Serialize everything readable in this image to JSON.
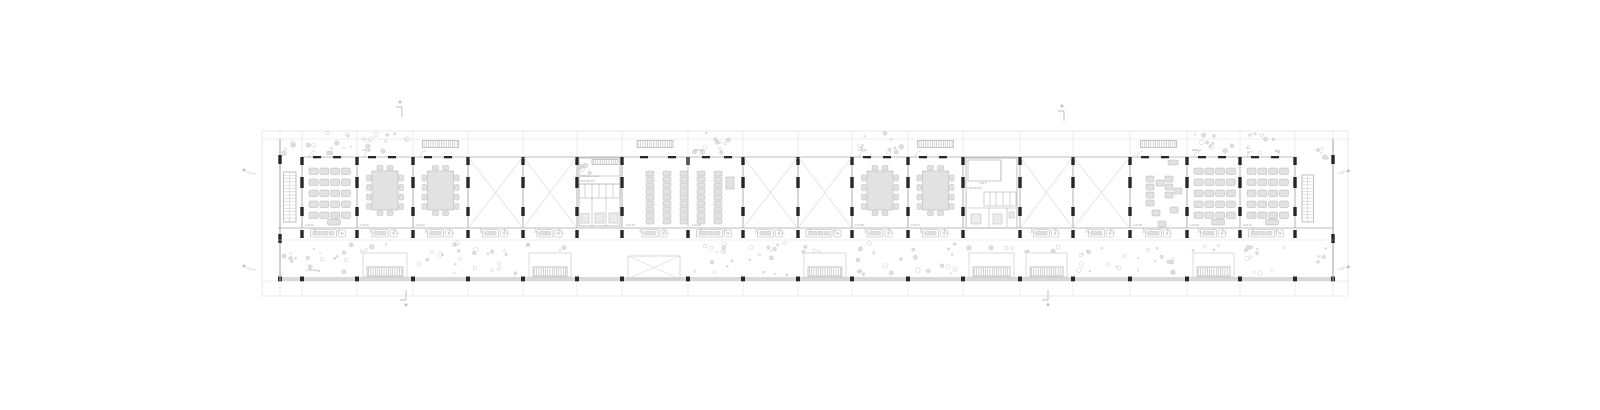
{
  "drawing_title": "floor-plan",
  "colors": {
    "bg": "#ffffff",
    "paving": "#e4e4e4",
    "line_light": "#dcdcdc",
    "line": "#c3c3c3",
    "wall": "#a9a9a9",
    "dark": "#272727",
    "furn_fill": "#e2e2e2",
    "furn_stroke": "#b4b4b4",
    "slab_fill": "#d9d9d9",
    "hatch": "#9e9e9e",
    "plant": "#c9c9c9",
    "label": "#9a9a9a",
    "xbrace": "#cfcfcf"
  },
  "plan": {
    "canvas": {
      "w": 1600,
      "h": 410
    },
    "outer": {
      "x1": 262,
      "y1": 131,
      "x2": 1348,
      "y2": 296
    },
    "slab": {
      "x1": 278,
      "y1": 139,
      "x2": 1333,
      "y2": 281
    },
    "levels": {
      "room_top": 157,
      "corridor": 228,
      "terrace_line": 240,
      "wall_bottom": 277,
      "slab_bottom": 281,
      "paving_bottom": 296
    },
    "walls_x": [
      280,
      302,
      357,
      413,
      468,
      523,
      577,
      622,
      688,
      743,
      798,
      852,
      908,
      963,
      1020,
      1073,
      1130,
      1187,
      1240,
      1295,
      1333
    ],
    "light_walls": [
      688
    ],
    "bays": [
      {
        "x": 280,
        "w": 22,
        "type": "stair",
        "dir": "left"
      },
      {
        "x": 302,
        "w": 55,
        "type": "classroom",
        "top": "plants",
        "bottom": "plants",
        "unit": "long"
      },
      {
        "x": 357,
        "w": 56,
        "type": "seminar",
        "top": "plants",
        "bottom": "planter",
        "unit": "short"
      },
      {
        "x": 413,
        "w": 55,
        "type": "seminar",
        "top": "louver",
        "bottom": "plants",
        "unit": "short"
      },
      {
        "x": 468,
        "w": 55,
        "type": "void",
        "top": "none",
        "bottom": "plants",
        "unit": "short"
      },
      {
        "x": 523,
        "w": 54,
        "type": "void",
        "top": "none",
        "bottom": "planter",
        "unit": "short"
      },
      {
        "x": 577,
        "w": 45,
        "type": "core1",
        "top": "none",
        "bottom": "none"
      },
      {
        "x": 622,
        "w": 66,
        "type": "lectureL",
        "top": "louver",
        "bottom": "xbox",
        "unit": "short"
      },
      {
        "x": 688,
        "w": 55,
        "type": "lectureR",
        "top": "plants",
        "bottom": "plants",
        "unit": "long"
      },
      {
        "x": 743,
        "w": 55,
        "type": "void",
        "top": "none",
        "bottom": "plants",
        "unit": "short"
      },
      {
        "x": 798,
        "w": 54,
        "type": "void",
        "top": "none",
        "bottom": "planter",
        "unit": "long"
      },
      {
        "x": 852,
        "w": 56,
        "type": "seminar",
        "top": "plants",
        "bottom": "plants",
        "unit": "short"
      },
      {
        "x": 908,
        "w": 55,
        "type": "seminar",
        "top": "louver",
        "bottom": "plants",
        "unit": "short"
      },
      {
        "x": 963,
        "w": 57,
        "type": "core2",
        "top": "none",
        "bottom": "planter"
      },
      {
        "x": 1020,
        "w": 53,
        "type": "void",
        "top": "none",
        "bottom": "planter",
        "unit": "short"
      },
      {
        "x": 1073,
        "w": 57,
        "type": "void",
        "top": "none",
        "bottom": "plants",
        "unit": "short"
      },
      {
        "x": 1130,
        "w": 57,
        "type": "group",
        "top": "louver",
        "bottom": "plants",
        "unit": "short"
      },
      {
        "x": 1187,
        "w": 53,
        "type": "classroom",
        "top": "plants",
        "bottom": "planter",
        "unit": "short"
      },
      {
        "x": 1240,
        "w": 55,
        "type": "classroom",
        "top": "plants",
        "bottom": "plants",
        "unit": "long"
      },
      {
        "x": 1295,
        "w": 38,
        "type": "stair",
        "dir": "right"
      }
    ],
    "group_desks": [
      [
        1146,
        176
      ],
      [
        1146,
        184
      ],
      [
        1146,
        192
      ],
      [
        1146,
        200
      ],
      [
        1156,
        180
      ],
      [
        1165,
        176
      ],
      [
        1165,
        184
      ],
      [
        1165,
        192
      ],
      [
        1174,
        188
      ],
      [
        1152,
        210
      ],
      [
        1170,
        207
      ],
      [
        1158,
        221
      ]
    ],
    "corner_plants": [
      [
        284,
        141
      ],
      [
        284,
        248
      ],
      [
        1318,
        146
      ],
      [
        1318,
        248
      ]
    ]
  },
  "room_labels": [
    {
      "text": "4.02.01",
      "x": 305,
      "y": 226
    },
    {
      "text": "4.02.02",
      "x": 360,
      "y": 226
    },
    {
      "text": "4.02.03",
      "x": 416,
      "y": 226
    },
    {
      "text": "4.02.04",
      "x": 626,
      "y": 226
    },
    {
      "text": "4.02.05",
      "x": 692,
      "y": 226
    },
    {
      "text": "4.02.06",
      "x": 855,
      "y": 226
    },
    {
      "text": "4.02.07",
      "x": 911,
      "y": 226
    },
    {
      "text": "4.02.08",
      "x": 1133,
      "y": 226
    },
    {
      "text": "4.02.09",
      "x": 1190,
      "y": 226
    },
    {
      "text": "4.02.10",
      "x": 1243,
      "y": 226
    },
    {
      "text": "4.03 Nebenraum",
      "x": 580,
      "y": 177
    },
    {
      "text": "4.04 WC D/H",
      "x": 580,
      "y": 182
    },
    {
      "text": "4.05 R",
      "x": 979,
      "y": 184
    },
    {
      "text": "4.06 WC D/H",
      "x": 967,
      "y": 189
    },
    {
      "text": "4.08.01",
      "x": 362,
      "y": 151
    },
    {
      "text": "4.08.02",
      "x": 694,
      "y": 151
    },
    {
      "text": "4.08.03",
      "x": 858,
      "y": 151
    },
    {
      "text": "4.08.04",
      "x": 1192,
      "y": 151
    },
    {
      "text": "1.Terrasse",
      "x": 306,
      "y": 271
    }
  ],
  "markers": {
    "top": [
      {
        "x": 400,
        "y": 102
      },
      {
        "x": 1062,
        "y": 106
      }
    ],
    "bottom": [
      {
        "x": 404,
        "y": 290
      },
      {
        "x": 1046,
        "y": 290
      }
    ],
    "left": [
      {
        "x": 244,
        "y": 170
      },
      {
        "x": 244,
        "y": 266
      }
    ],
    "right": [
      {
        "x": 1347,
        "y": 171
      },
      {
        "x": 1347,
        "y": 267
      }
    ]
  }
}
